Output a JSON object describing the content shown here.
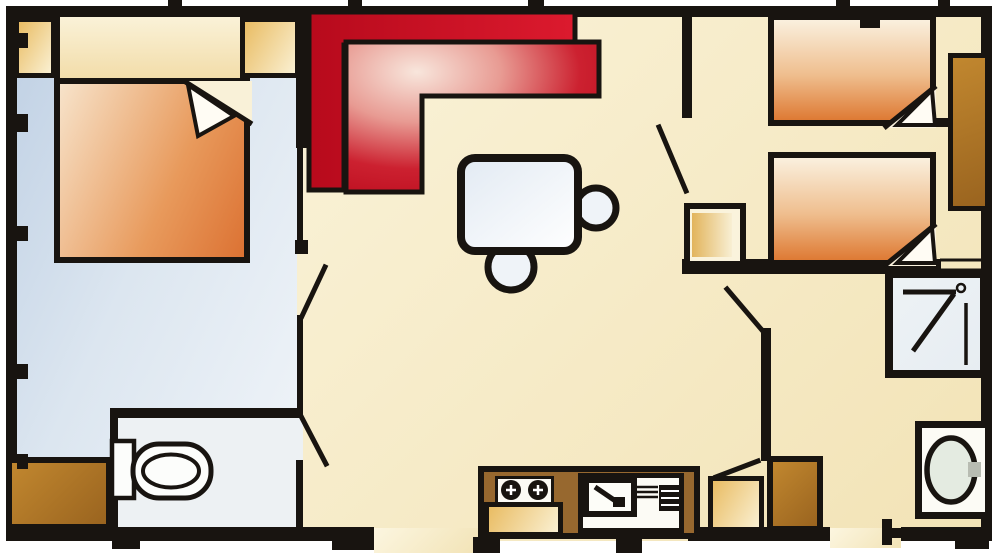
{
  "document": {
    "type": "floor-plan",
    "subject": "top-down floor plan of a mobile home / holiday caravan",
    "aria_label": "Mobile home floor plan with double bedroom, twin bedroom, living and kitchen area, WC and shower room"
  },
  "palette": {
    "wall": "#181410",
    "page": "#ffffff",
    "living-a": "#fcf6e0",
    "living-b": "#f2e3b6",
    "bedroom-a": "#bfd0e4",
    "bedroom-b": "#f1f5f9",
    "wc-floor": "#edf1f3",
    "sofa-back-a": "#b70a1c",
    "sofa-back-b": "#dc1a2e",
    "sofa-seat-light": "#f8e6dc",
    "sofa-seat-dark": "#bb0a1c",
    "bed-cream": "#faf0de",
    "bed-mid": "#efbe8e",
    "bed-orange": "#de7a34",
    "blanket-a": "#f7e3ca",
    "blanket-b": "#e89a5c",
    "blanket-c": "#dc7233",
    "tan-a": "#e9bc63",
    "tan-b": "#faf0d2",
    "brown-a": "#c1872f",
    "brown-b": "#9a641f",
    "counter": "#97682f",
    "fixture": "#fcfbf5",
    "basin": "#e4ebe1",
    "shower-fill": "#e7edf2",
    "table-a": "#e2eaf3",
    "table-b": "#ffffff",
    "chair": "#eff3f8",
    "tap": "#b8bcb2"
  },
  "rooms": [
    {
      "id": "master-bedroom",
      "label": "double bedroom",
      "floor": "light blue"
    },
    {
      "id": "living-kitchen",
      "label": "living room with kitchen",
      "floor": "cream"
    },
    {
      "id": "twin-bedroom",
      "label": "twin bedroom",
      "floor": "cream"
    },
    {
      "id": "wc",
      "label": "WC room",
      "floor": "pale grey"
    },
    {
      "id": "bathroom-corridor",
      "label": "shower and washbasin area",
      "floor": "cream"
    }
  ],
  "furniture": [
    {
      "id": "double-bed",
      "label": "double bed with turned-down corner",
      "room": "master-bedroom"
    },
    {
      "id": "wardrobe-left",
      "label": "bedside wardrobe",
      "room": "master-bedroom"
    },
    {
      "id": "wardrobe-right",
      "label": "bedside wardrobe",
      "room": "master-bedroom"
    },
    {
      "id": "corner-sofa",
      "label": "L-shaped corner sofa",
      "room": "living-kitchen"
    },
    {
      "id": "dining-table",
      "label": "dining table",
      "room": "living-kitchen"
    },
    {
      "id": "chair-right",
      "label": "round chair",
      "room": "living-kitchen"
    },
    {
      "id": "chair-bottom",
      "label": "round chair",
      "room": "living-kitchen"
    },
    {
      "id": "kitchen-counter",
      "label": "kitchen counter",
      "room": "living-kitchen"
    },
    {
      "id": "hob",
      "label": "two-burner hob",
      "room": "living-kitchen"
    },
    {
      "id": "kitchen-sink",
      "label": "kitchen sink with drainer",
      "room": "living-kitchen"
    },
    {
      "id": "single-bed-top",
      "label": "single bed with turned-down corner",
      "room": "twin-bedroom"
    },
    {
      "id": "single-bed-bottom",
      "label": "single bed with turned-down corner",
      "room": "twin-bedroom"
    },
    {
      "id": "tall-wardrobe",
      "label": "tall wardrobe",
      "room": "twin-bedroom"
    },
    {
      "id": "hall-cabinet",
      "label": "low cabinet",
      "room": "twin-bedroom"
    },
    {
      "id": "toilet",
      "label": "toilet with cistern",
      "room": "wc"
    },
    {
      "id": "wc-side-cabinet",
      "label": "storage cabinet",
      "room": "master-bedroom"
    },
    {
      "id": "shower",
      "label": "shower tray with shower arm",
      "room": "bathroom-corridor"
    },
    {
      "id": "washbasin",
      "label": "washbasin with tap",
      "room": "bathroom-corridor"
    },
    {
      "id": "corridor-cabinet-tan",
      "label": "low cabinet",
      "room": "bathroom-corridor"
    },
    {
      "id": "corridor-cabinet-brown",
      "label": "low cabinet",
      "room": "bathroom-corridor"
    }
  ],
  "doors": [
    {
      "id": "door-master-bedroom",
      "label": "swing door to double bedroom"
    },
    {
      "id": "door-wc",
      "label": "swing door to WC"
    },
    {
      "id": "door-twin-bedroom",
      "label": "swing door to twin bedroom"
    },
    {
      "id": "door-bathroom",
      "label": "swing door to shower area"
    },
    {
      "id": "door-corridor",
      "label": "swing door by corridor cabinet"
    },
    {
      "id": "entrance-front",
      "label": "front entrance opening in bottom wall"
    },
    {
      "id": "entrance-rear",
      "label": "rear door opening in bottom wall"
    }
  ],
  "windows": [
    {
      "id": "window-right",
      "label": "window on right wall below tall wardrobe"
    }
  ]
}
